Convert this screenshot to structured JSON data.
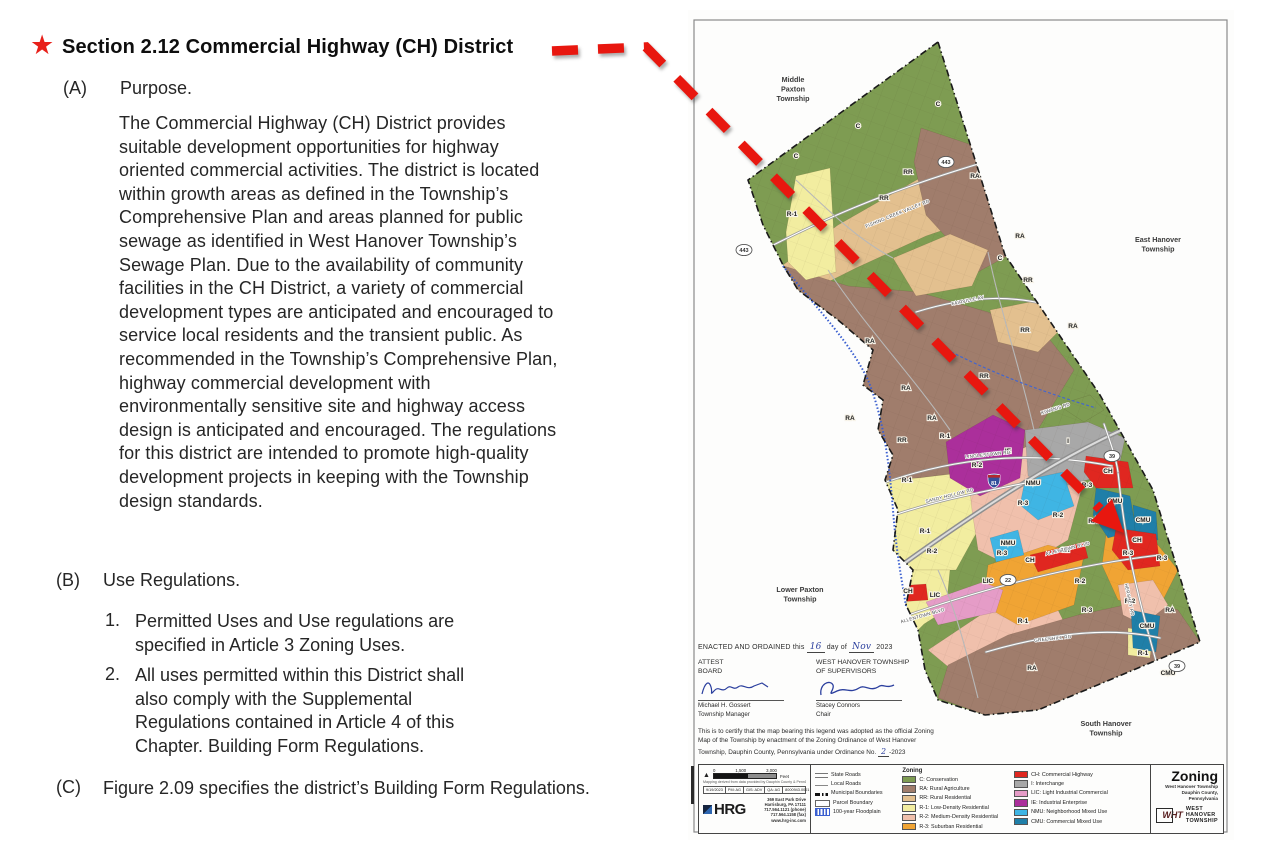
{
  "icons": {
    "star": "★",
    "north": "▲"
  },
  "doc": {
    "title": "Section 2.12 Commercial Highway (CH) District",
    "a": {
      "label": "(A)",
      "heading": "Purpose.",
      "body": "The Commercial Highway (CH) District provides suitable development opportunities for highway oriented commercial activities. The district is located within growth areas as defined in the Township’s Comprehensive Plan and areas planned for public sewage as identified in West Hanover Township’s Sewage Plan. Due to the availability of community facilities in the CH District, a variety of commercial development types are anticipated and encouraged to service local residents and the transient public. As recommended in the Township’s Comprehensive Plan, highway commercial development with environmentally sensitive site and highway access design is anticipated and encouraged. The regulations for this district are intended to promote high-quality development projects in keeping with the Township design standards."
    },
    "b": {
      "label": "(B)",
      "heading": "Use Regulations.",
      "items": [
        {
          "num": "1.",
          "text": "Permitted Uses and Use regulations are specified in Article 3 Zoning Uses."
        },
        {
          "num": "2.",
          "text": "All uses permitted within this District shall also comply with the Supplemental Regulations contained in Article 4 of this Chapter. Building Form Regulations."
        }
      ]
    },
    "c": {
      "label": "(C)",
      "body": "Figure 2.09 specifies the district’s Building Form Regulations."
    }
  },
  "map": {
    "neighbors": [
      {
        "x": 105,
        "y": 72,
        "lines": [
          "Middle",
          "Paxton",
          "Township"
        ]
      },
      {
        "x": 470,
        "y": 232,
        "lines": [
          "East Hanover",
          "Township"
        ]
      },
      {
        "x": 112,
        "y": 582,
        "lines": [
          "Lower Paxton",
          "Township"
        ]
      },
      {
        "x": 418,
        "y": 716,
        "lines": [
          "South Hanover",
          "Township"
        ]
      }
    ],
    "area_labels": [
      {
        "t": "C",
        "x": 250,
        "y": 96
      },
      {
        "t": "C",
        "x": 108,
        "y": 148
      },
      {
        "t": "C",
        "x": 312,
        "y": 250
      },
      {
        "t": "C",
        "x": 170,
        "y": 118
      },
      {
        "t": "RA",
        "x": 287,
        "y": 168
      },
      {
        "t": "RA",
        "x": 332,
        "y": 228
      },
      {
        "t": "RA",
        "x": 182,
        "y": 333
      },
      {
        "t": "RA",
        "x": 218,
        "y": 380
      },
      {
        "t": "RA",
        "x": 244,
        "y": 410
      },
      {
        "t": "RA",
        "x": 385,
        "y": 318
      },
      {
        "t": "RA",
        "x": 162,
        "y": 410
      },
      {
        "t": "RA",
        "x": 405,
        "y": 513
      },
      {
        "t": "RA",
        "x": 344,
        "y": 660
      },
      {
        "t": "RA",
        "x": 482,
        "y": 602
      },
      {
        "t": "RR",
        "x": 220,
        "y": 164
      },
      {
        "t": "RR",
        "x": 196,
        "y": 190
      },
      {
        "t": "RR",
        "x": 340,
        "y": 272
      },
      {
        "t": "RR",
        "x": 296,
        "y": 368
      },
      {
        "t": "RR",
        "x": 214,
        "y": 432
      },
      {
        "t": "RR",
        "x": 337,
        "y": 322
      },
      {
        "t": "R-1",
        "x": 104,
        "y": 206
      },
      {
        "t": "R-1",
        "x": 257,
        "y": 428
      },
      {
        "t": "R-1",
        "x": 219,
        "y": 472
      },
      {
        "t": "R-1",
        "x": 237,
        "y": 523
      },
      {
        "t": "R-1",
        "x": 335,
        "y": 613
      },
      {
        "t": "R-1",
        "x": 455,
        "y": 645
      },
      {
        "t": "R-2",
        "x": 289,
        "y": 457
      },
      {
        "t": "R-2",
        "x": 370,
        "y": 507
      },
      {
        "t": "R-2",
        "x": 244,
        "y": 543
      },
      {
        "t": "R-2",
        "x": 392,
        "y": 573
      },
      {
        "t": "R-2",
        "x": 442,
        "y": 593
      },
      {
        "t": "R-3",
        "x": 399,
        "y": 477
      },
      {
        "t": "R-3",
        "x": 335,
        "y": 495
      },
      {
        "t": "R-3",
        "x": 314,
        "y": 545
      },
      {
        "t": "R-3",
        "x": 440,
        "y": 545
      },
      {
        "t": "R-3",
        "x": 399,
        "y": 602
      },
      {
        "t": "R-3",
        "x": 474,
        "y": 550
      },
      {
        "t": "NMU",
        "x": 345,
        "y": 475
      },
      {
        "t": "NMU",
        "x": 320,
        "y": 535
      },
      {
        "t": "CMU",
        "x": 427,
        "y": 493
      },
      {
        "t": "CMU",
        "x": 455,
        "y": 512
      },
      {
        "t": "CMU",
        "x": 459,
        "y": 618
      },
      {
        "t": "CMU",
        "x": 480,
        "y": 665
      },
      {
        "t": "CH",
        "x": 420,
        "y": 463
      },
      {
        "t": "CH",
        "x": 449,
        "y": 532
      },
      {
        "t": "CH",
        "x": 377,
        "y": 542
      },
      {
        "t": "CH",
        "x": 342,
        "y": 552
      },
      {
        "t": "CH",
        "x": 220,
        "y": 583
      },
      {
        "t": "LIC",
        "x": 300,
        "y": 573
      },
      {
        "t": "LIC",
        "x": 247,
        "y": 587
      },
      {
        "t": "IE",
        "x": 320,
        "y": 443
      },
      {
        "t": "I",
        "x": 380,
        "y": 433
      }
    ],
    "road_labels": [
      {
        "t": "LINGLESTOWN RD",
        "x": 300,
        "y": 446,
        "r": -6
      },
      {
        "t": "SANDY HOLLOW RD",
        "x": 262,
        "y": 487,
        "r": -14
      },
      {
        "t": "ALLENTOWN BLVD",
        "x": 380,
        "y": 540,
        "r": -14
      },
      {
        "t": "ALLENTOWN BLVD",
        "x": 235,
        "y": 607,
        "r": -16
      },
      {
        "t": "HERSHEY RD",
        "x": 440,
        "y": 590,
        "r": 78
      },
      {
        "t": "GREENHILL RD",
        "x": 365,
        "y": 630,
        "r": -6
      },
      {
        "t": "FISHING CREEK VALLEY RD",
        "x": 210,
        "y": 205,
        "r": -22
      },
      {
        "t": "FAIRVILLE AV",
        "x": 280,
        "y": 292,
        "r": -12
      },
      {
        "t": "KIWANIS RD",
        "x": 368,
        "y": 400,
        "r": -18
      }
    ],
    "shields": [
      {
        "t": "443",
        "x": 258,
        "y": 152
      },
      {
        "t": "443",
        "x": 56,
        "y": 240
      },
      {
        "t": "39",
        "x": 424,
        "y": 446
      },
      {
        "t": "39",
        "x": 489,
        "y": 656
      },
      {
        "t": "22",
        "x": 320,
        "y": 570
      }
    ],
    "interstate": {
      "t": "81",
      "x": 306,
      "y": 470
    },
    "enacted": {
      "line": "ENACTED AND ORDAINED this",
      "day": "16",
      "mid": "day of",
      "month": "Nov",
      "year": "2023",
      "attest_1": "ATTEST",
      "attest_2": "BOARD",
      "supervisors_1": "WEST HANOVER TOWNSHIP",
      "supervisors_2": "OF SUPERVISORS",
      "manager_name": "Michael H. Gossert",
      "manager_title": "Township Manager",
      "chair_name": "Stacey Connors",
      "chair_title": "Chair",
      "certify": "This is to certify that the map bearing this legend was adopted as the official Zoning Map of the Township by enactment of the Zoning Ordinance of West Hanover Township, Dauphin County, Pennsylvania under Ordinance No.",
      "ordinance_no": "2",
      "ordinance_suffix": "-2023"
    },
    "scalebar": {
      "t0": "0",
      "t1": "1,500",
      "t2": "3,000",
      "unit": "Feet",
      "credit": "Mapping derived from data provided by Dauphin County & PennDOT",
      "cells": [
        "9/19/2023",
        "PM: AG",
        "GIS: ADV",
        "QA: AG",
        "8000943.0001"
      ]
    },
    "hrg": {
      "name": "HRG",
      "address": [
        "369 East Park Drive",
        "Harrisburg, PA 17111",
        "717.564.1121 (phone)",
        "717.564.1158 (fax)",
        "www.hrg-inc.com"
      ]
    },
    "legend": {
      "symbols": [
        {
          "label": "State Roads",
          "type": "state"
        },
        {
          "label": "Local Roads",
          "type": "local"
        },
        {
          "label": "Municipal Boundaries",
          "type": "municipal"
        },
        {
          "label": "Parcel Boundary",
          "type": "parcel"
        },
        {
          "label": "100-year Floodplain",
          "type": "flood"
        }
      ],
      "zoning_header": "Zoning",
      "zoning_col1": [
        {
          "code": "C",
          "label": "C: Conservation",
          "color": "#7e9c52"
        },
        {
          "code": "RA",
          "label": "RA: Rural Agriculture",
          "color": "#a07d6c"
        },
        {
          "code": "RR",
          "label": "RR: Rural Residential",
          "color": "#e3c08f"
        },
        {
          "code": "R-1",
          "label": "R-1: Low-Density Residential",
          "color": "#f2eda0"
        },
        {
          "code": "R-2",
          "label": "R-2: Medium-Density Residential",
          "color": "#f0c0ac"
        },
        {
          "code": "R-3",
          "label": "R-3: Suburban Residential",
          "color": "#f0a434"
        }
      ],
      "zoning_col2": [
        {
          "code": "CH",
          "label": "CH: Commercial Highway",
          "color": "#e02720"
        },
        {
          "code": "I",
          "label": "I: Interchange",
          "color": "#a8a8a8"
        },
        {
          "code": "LIC",
          "label": "LIC: Light Industrial Commercial",
          "color": "#e59cc7"
        },
        {
          "code": "IE",
          "label": "IE: Industrial Enterprise",
          "color": "#ab2f9b"
        },
        {
          "code": "NMU",
          "label": "NMU: Neighborhood Mixed Use",
          "color": "#3fb5e4"
        },
        {
          "code": "CMU",
          "label": "CMU: Commercial Mixed Use",
          "color": "#1f7fa8"
        }
      ]
    },
    "title_block": {
      "title": "Zoning",
      "sub1": "West Hanover Township",
      "sub2": "Dauphin County, Pennsylvania",
      "logo_abbr": "WHT",
      "logo_lines": [
        "WEST",
        "HANOVER",
        "TOWNSHIP"
      ]
    }
  }
}
